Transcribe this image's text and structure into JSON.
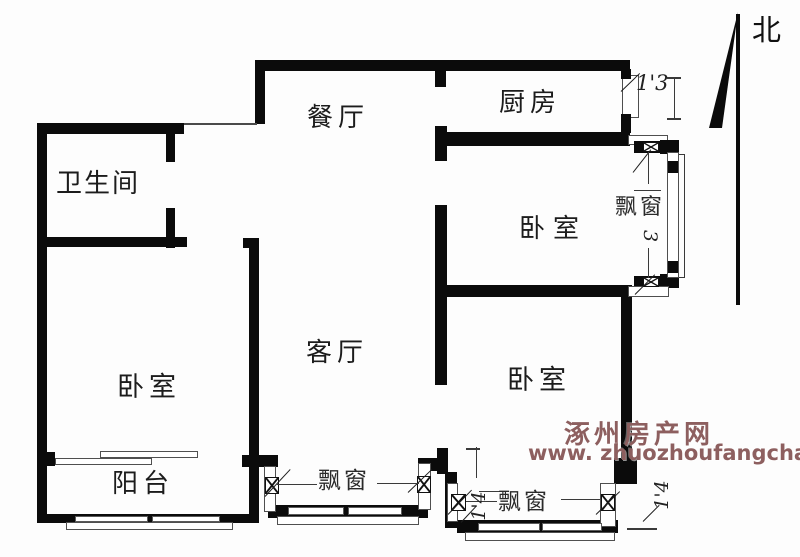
{
  "compass": {
    "label": "北"
  },
  "watermark": {
    "line1": "涿州房产网",
    "line2": "www. zhuozhoufangchan. com",
    "color": "#8d5f5f"
  },
  "rooms": {
    "bathroom": "卫生间",
    "dining_room": "餐厅",
    "kitchen": "厨房",
    "bedroom_northeast": "卧室",
    "living_room": "客厅",
    "bedroom_southwest": "卧室",
    "bedroom_southeast": "卧室",
    "balcony": "阳台"
  },
  "bay_windows": {
    "east_label": "飘窗",
    "living_south_label": "飘窗",
    "bedroom_south_label": "飘窗"
  },
  "dimensions": {
    "kitchen_window": "1'3",
    "east_bay_depth": "3",
    "south_bay_left": "1'4",
    "south_bay_right": "1'4"
  }
}
